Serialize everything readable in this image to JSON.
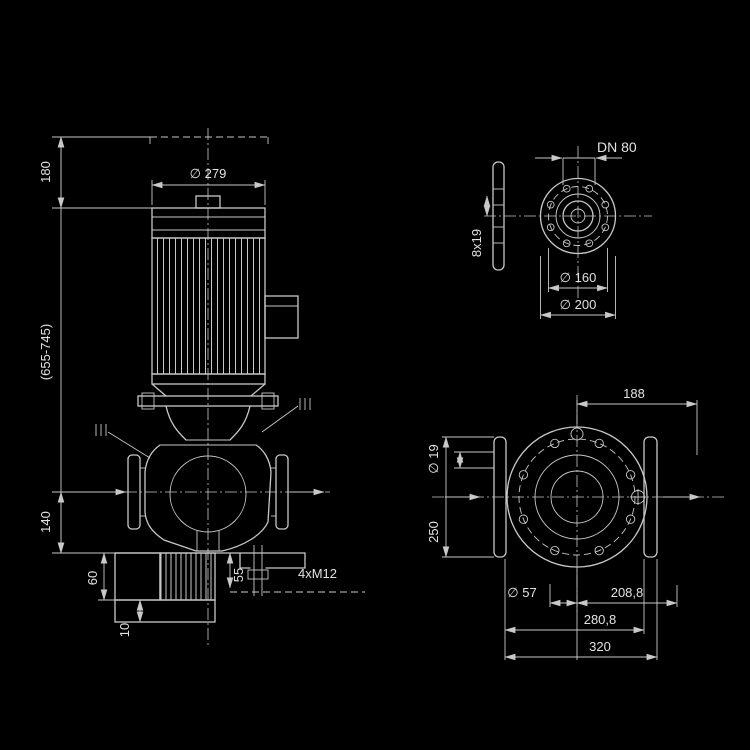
{
  "colors": {
    "background": "#000000",
    "line": "#c8c8c8",
    "text": "#e2e2e2"
  },
  "main_view": {
    "motor_diameter": "∅ 279",
    "top_clearance": "180",
    "overall_height": "(655-745)",
    "port_height": "140",
    "foot_height": "60",
    "plate_thickness": "10",
    "foot_edge": "55",
    "mounting_holes": "4xM12"
  },
  "flange_view": {
    "nominal": "DN 80",
    "holes": "8x19",
    "bolt_circle": "∅ 160",
    "outer_diameter": "∅ 200"
  },
  "plan_view": {
    "upper_width": "188",
    "hole_diameter": "∅ 19",
    "flange_height": "250",
    "volute_offset": "∅ 57",
    "center_to_edge": "208,8",
    "flange_span": "280,8",
    "overall_width": "320"
  }
}
